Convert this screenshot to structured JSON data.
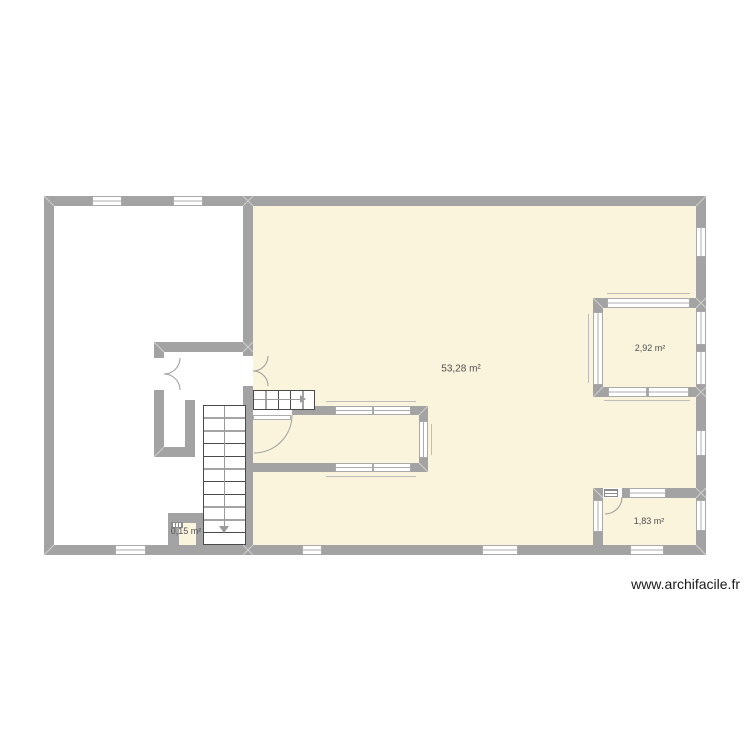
{
  "colors": {
    "wall": "#a3a3a3",
    "room_fill": "#faf4dd",
    "line": "#9a9a9a",
    "stair_line": "#4a4a4a",
    "sill": "#bdbdbd",
    "miter": "#cfcfcf",
    "label": "#4f4f4f",
    "watermark": "#1a1a1a"
  },
  "plan": {
    "rooms": [
      {
        "name": "main-room",
        "area_label": "53,28 m²"
      },
      {
        "name": "top-right-room",
        "area_label": "2,92 m²"
      },
      {
        "name": "bottom-right-room",
        "area_label": "1,83 m²"
      },
      {
        "name": "closet",
        "area_label": "0,15 m²"
      }
    ]
  },
  "watermark": {
    "text": "www.archifacile.fr"
  }
}
